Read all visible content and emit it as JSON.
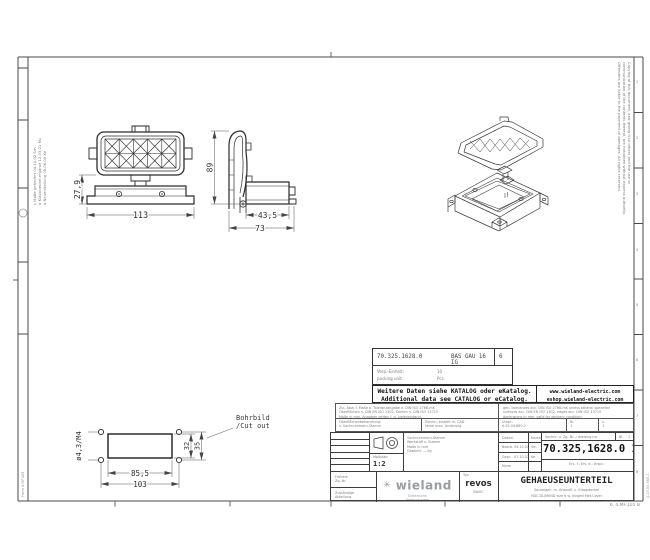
{
  "views": {
    "top": {
      "dim_width": "113",
      "dim_height": "27,9"
    },
    "side": {
      "dim_height": "89",
      "dim_body": "43,5",
      "dim_total": "73"
    }
  },
  "cutout": {
    "title1": "Bohrbild",
    "title2": "/Cut out",
    "w_inner": "85,5",
    "w_outer": "103",
    "h_inner": "32",
    "h_outer": "35",
    "hole_spec": "ø4,3/M4"
  },
  "part_table": {
    "number": "70.325.1628.0",
    "type": "BAS GAU 16 IG",
    "index": "6",
    "l1": "Verp.-Einheit:",
    "v1": "10",
    "l2": "packing unit:",
    "v2": "Pcs."
  },
  "catalog": {
    "de": "Weitere Daten siehe KATALOG oder eKatalog.",
    "en": "Additional data see CATALOG or eCatalog.",
    "url1": "www.wieland-electric.com",
    "url2": "eshop.wieland-electric.com"
  },
  "legal": {
    "de1": "Zul. Abw. f. Maße o. Toleranzangabe n. DIN ISO 2768-mK",
    "de2": "Oberflächen n. DIN EN ISO 1302, Kanten n. DIN ISO 13715",
    "de3": "Maße in mm. Angaben gelten f. d. Lieferzustand.",
    "en1": "gen. tolerances acc. DIN ISO 2768-mK unless otherw. specified",
    "en2": "surfaces acc. DIN EN ISO 1302, edges acc. DIN ISO 13715",
    "en3": "dimensions in mm, valid for delivery condition",
    "s1a": "Oberflächenbehandlung:",
    "s1b": "s. Sachnummern-Stamm",
    "s2a": "Zeichn. erstellt m. CAD",
    "s2b": "keine man. Änderung",
    "s3a": "Urspr.:",
    "s3b": "4.25.04.680.2",
    "s4a": "Bl.",
    "s4b": "1",
    "s5a": "v.",
    "s5b": "1"
  },
  "titleblock": {
    "scale_label": "Maßstab",
    "scale": "1:2",
    "tol1": "Sachnummern-Stamm",
    "tol2": "Werkstoff s. Stamm",
    "tol3": "Maße in mm",
    "tol4": "Gewicht: — kg",
    "col_date": "Datum",
    "col_name": "Name",
    "row_bearb": "Bearb.",
    "bearb_date": "04.10.02",
    "bearb_name": "Sm",
    "row_gepr": "Gepr.",
    "gepr_date": "07.10.02",
    "gepr_name": "Ke",
    "row_norm": "Norm",
    "dwg_label": "Sachnr. u. Zg.-Nr. / drawing no.",
    "sheet_label": "Bl.",
    "sheet_no": "1",
    "dwg_no": "70.325,1628.0 13K",
    "note": "Ers. f.:      Ers. d.:      Urspr.:",
    "b1_l1": "Frühere",
    "b1_l2": "Zg.-Nr.",
    "b2_l1": "Zuständige",
    "b2_l2": "Abteilung",
    "brand_icon": "✳",
    "brand": "wieland",
    "brand_sub1": "Elektrische",
    "brand_sub2": "Verbindungen",
    "type_label": "Typ",
    "series": "revos",
    "series_sub": "BASIC",
    "title": "GEHAEUSEUNTERTEIL",
    "sub_de": "Sockelgeh. m. Anbaufl. u. Klappdeckel",
    "sub_en": "HDC DL/MEND size 6 w. hinged Met.Cover"
  },
  "edges": {
    "right1": "Copying of this document, and giving it to others and the use or",
    "right2": "communication of the contents thereof, are forbidden without express authority.",
    "right3": "Offenders are liable to the payment of damages. All rights reserved.",
    "left1": "c  Maße geändert  04.10.02  Sm",
    "left2": "b  Klappdeckel ergänzt  12.03.01  Mu",
    "left3": "a  Neuerstellung  05.06.00  Ke",
    "form_bl": "Form 4.MF.105",
    "form_br": "b.  4.MF.105 B",
    "ref_right": "4.25.04.680.2",
    "grid": [
      "1",
      "2",
      "3",
      "4",
      "5",
      "6",
      "7",
      "8"
    ]
  }
}
